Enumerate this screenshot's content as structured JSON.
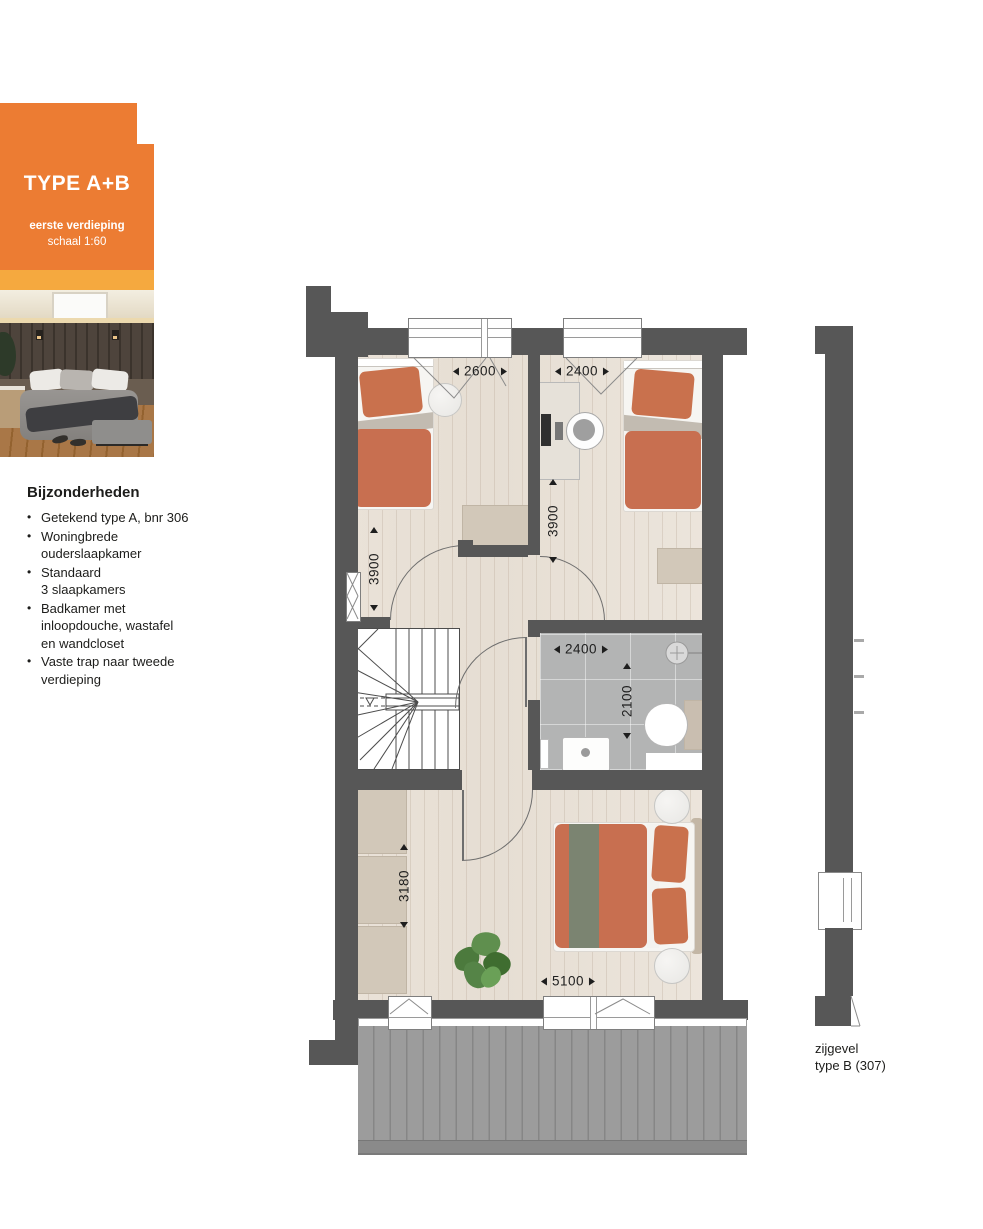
{
  "badge": {
    "title": "TYPE A+B",
    "subtitle_line1": "eerste verdieping",
    "subtitle_line2": "schaal 1:60",
    "color_main": "#EC7C33",
    "color_accent": "#F5A93F"
  },
  "features": {
    "heading": "Bijzonderheden",
    "items": [
      "Getekend type A, bnr 306",
      "Woningbrede\nouderslaapkamer",
      "Standaard\n3 slaapkamers",
      "Badkamer met\ninloopdouche, wastafel\nen wandcloset",
      "Vaste trap naar tweede\nverdieping"
    ]
  },
  "plan": {
    "dims": {
      "bedroom1_width": "2600",
      "bedroom2_width": "2400",
      "bedroom1_depth": "3900",
      "bedroom2_depth": "3900",
      "bathroom_width": "2400",
      "bathroom_depth": "2100",
      "master_depth": "3180",
      "master_width": "5100"
    },
    "colors": {
      "wall": "#575757",
      "terracotta": "#C86F50",
      "tile": "#B4B4B4",
      "deck": "#9C9C9C"
    }
  },
  "side_elevation": {
    "label_line1": "zijgevel",
    "label_line2": "type B (307)"
  }
}
